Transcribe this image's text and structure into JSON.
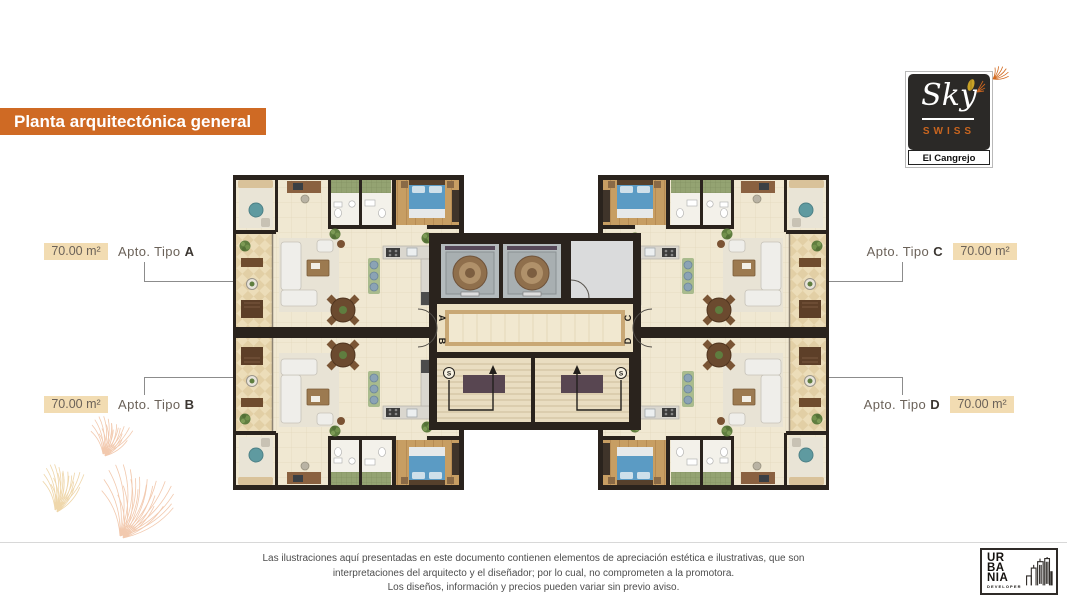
{
  "banner": {
    "title": "Planta arquitectónica general"
  },
  "brand": {
    "name": "Sky",
    "tagline": "SWISS",
    "location": "El Cangrejo"
  },
  "apartments": [
    {
      "id": "A",
      "side": "left",
      "area": "70.00 m²",
      "label": "Apto. Tipo",
      "letter": "A"
    },
    {
      "id": "B",
      "side": "left",
      "area": "70.00 m²",
      "label": "Apto. Tipo",
      "letter": "B"
    },
    {
      "id": "C",
      "side": "right",
      "area": "70.00 m²",
      "label": "Apto. Tipo",
      "letter": "C"
    },
    {
      "id": "D",
      "side": "right",
      "area": "70.00 m²",
      "label": "Apto. Tipo",
      "letter": "D"
    }
  ],
  "plan": {
    "unit_markers": {
      "a": "A",
      "b": "B",
      "c": "C",
      "d": "D"
    },
    "stair_marker": "S"
  },
  "footer": {
    "disclaimer": [
      "Las ilustraciones aquí presentadas en este documento contienen elementos de apreciación estética e ilustrativas, que son",
      "interpretaciones del arquitecto y el diseñador; por lo cual, no comprometen a la promotora.",
      "Los diseños, información y precios pueden variar sin previo aviso."
    ],
    "developer": {
      "name_lines": [
        "UR",
        "BA",
        "NIA"
      ],
      "descriptor": "DEVELOPER"
    }
  },
  "colors": {
    "accent_orange": "#cf6a24",
    "tan_badge": "#f2dcb2",
    "wall_dark": "#2a231d",
    "floor_beige": "#f0e8d2",
    "bed_blue": "#5b9bc4",
    "bath_green": "#94a372"
  }
}
